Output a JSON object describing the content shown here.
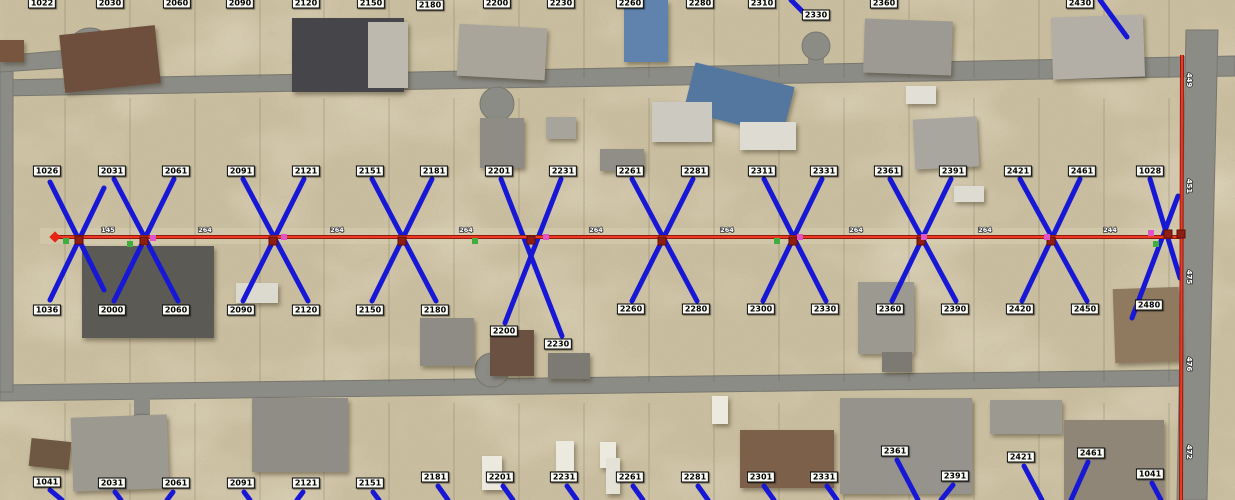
{
  "app": {
    "name": "aerial-utility-service-map"
  },
  "palette": {
    "terrain": "#c9bd9f",
    "terrain_light": "#ddd3b6",
    "scrub_dark": "#6b6350",
    "road": "#8c8c86",
    "road_edge": "#77776f",
    "service_blue": "#1717d6",
    "main_red": "#ee3a22",
    "main_red_dark": "#8f1b10",
    "node_crossing": "#8e1e12",
    "node_green": "#3fae3f",
    "node_magenta": "#e054c8",
    "terminus_red": "#e82416",
    "label_bg": "#fbfbf6",
    "label_border": "#000000"
  },
  "roads": [
    {
      "name": "top-road",
      "points": "0,80 1235,56 1235,76 0,96"
    },
    {
      "name": "bottom-road",
      "points": "0,385 1180,370 1180,386 0,401"
    },
    {
      "name": "right-road",
      "points": "1186,30 1218,30 1207,500 1177,500"
    },
    {
      "name": "left-road",
      "points": "0,58 13,58 13,392 0,392"
    },
    {
      "name": "top-left-spur",
      "points": "0,56 92,48 92,66 0,72"
    }
  ],
  "road_bulbs": [
    {
      "x": 90,
      "y": 50,
      "r": 22
    },
    {
      "x": 142,
      "y": 434,
      "r": 20
    },
    {
      "x": 497,
      "y": 104,
      "r": 17
    },
    {
      "x": 492,
      "y": 370,
      "r": 17
    },
    {
      "x": 816,
      "y": 46,
      "r": 14
    }
  ],
  "road_stubs": [
    {
      "x": 489,
      "y": 86,
      "w": 16,
      "h": 22
    },
    {
      "x": 484,
      "y": 360,
      "w": 16,
      "h": 28
    },
    {
      "x": 134,
      "y": 396,
      "w": 16,
      "h": 40
    },
    {
      "x": 808,
      "y": 42,
      "w": 16,
      "h": 28
    }
  ],
  "parcel_xs": [
    65,
    130,
    195,
    260,
    324,
    389,
    454,
    519,
    584,
    649,
    714,
    779,
    844,
    909,
    974,
    1039,
    1104,
    1169
  ],
  "houses": [
    {
      "x": 0,
      "y": 40,
      "w": 24,
      "h": 22,
      "c": "#77553f",
      "r": 0
    },
    {
      "x": 62,
      "y": 30,
      "w": 96,
      "h": 58,
      "c": "#6e4e3c",
      "r": -6
    },
    {
      "x": 292,
      "y": 18,
      "w": 112,
      "h": 74,
      "c": "#46454a",
      "r": 0
    },
    {
      "x": 368,
      "y": 22,
      "w": 40,
      "h": 66,
      "c": "#bdb9ae",
      "r": 0
    },
    {
      "x": 458,
      "y": 26,
      "w": 88,
      "h": 52,
      "c": "#a9a59b",
      "r": 3
    },
    {
      "x": 624,
      "y": 0,
      "w": 44,
      "h": 62,
      "c": "#5f83ad",
      "r": 0
    },
    {
      "x": 688,
      "y": 74,
      "w": 102,
      "h": 50,
      "c": "#53779f",
      "r": 14
    },
    {
      "x": 864,
      "y": 20,
      "w": 88,
      "h": 54,
      "c": "#9d9a93",
      "r": 2
    },
    {
      "x": 1052,
      "y": 16,
      "w": 92,
      "h": 62,
      "c": "#b3afa6",
      "r": -2
    },
    {
      "x": 906,
      "y": 86,
      "w": 30,
      "h": 18,
      "c": "#e2dfd6",
      "r": 0
    },
    {
      "x": 82,
      "y": 246,
      "w": 132,
      "h": 92,
      "c": "#5b5a55",
      "r": 0
    },
    {
      "x": 236,
      "y": 283,
      "w": 42,
      "h": 20,
      "c": "#dcd9cf",
      "r": 0
    },
    {
      "x": 480,
      "y": 118,
      "w": 44,
      "h": 50,
      "c": "#8f8c85",
      "r": 0
    },
    {
      "x": 546,
      "y": 117,
      "w": 30,
      "h": 22,
      "c": "#a7a49c",
      "r": 0
    },
    {
      "x": 652,
      "y": 102,
      "w": 60,
      "h": 40,
      "c": "#ccc9c0",
      "r": 0
    },
    {
      "x": 740,
      "y": 122,
      "w": 56,
      "h": 28,
      "c": "#dedbd2",
      "r": 0
    },
    {
      "x": 600,
      "y": 149,
      "w": 44,
      "h": 22,
      "c": "#918e87",
      "r": 0
    },
    {
      "x": 914,
      "y": 118,
      "w": 64,
      "h": 50,
      "c": "#a9a6a0",
      "r": -3
    },
    {
      "x": 954,
      "y": 186,
      "w": 30,
      "h": 16,
      "c": "#dedbd2",
      "r": 0
    },
    {
      "x": 420,
      "y": 318,
      "w": 54,
      "h": 48,
      "c": "#8f8c85",
      "r": 0
    },
    {
      "x": 490,
      "y": 330,
      "w": 44,
      "h": 46,
      "c": "#6b5141",
      "r": 0
    },
    {
      "x": 548,
      "y": 353,
      "w": 42,
      "h": 26,
      "c": "#7d7a73",
      "r": 0
    },
    {
      "x": 858,
      "y": 282,
      "w": 56,
      "h": 72,
      "c": "#9c9991",
      "r": 0
    },
    {
      "x": 882,
      "y": 352,
      "w": 30,
      "h": 20,
      "c": "#7d7a73",
      "r": 0
    },
    {
      "x": 1114,
      "y": 288,
      "w": 66,
      "h": 74,
      "c": "#8f7a60",
      "r": -2
    },
    {
      "x": 30,
      "y": 440,
      "w": 40,
      "h": 28,
      "c": "#6e5844",
      "r": 6
    },
    {
      "x": 72,
      "y": 416,
      "w": 96,
      "h": 74,
      "c": "#9c9991",
      "r": -2
    },
    {
      "x": 252,
      "y": 398,
      "w": 96,
      "h": 74,
      "c": "#908d86",
      "r": 0
    },
    {
      "x": 740,
      "y": 430,
      "w": 94,
      "h": 58,
      "c": "#7c604a",
      "r": 0
    },
    {
      "x": 840,
      "y": 398,
      "w": 132,
      "h": 96,
      "c": "#96938c",
      "r": 0
    },
    {
      "x": 990,
      "y": 400,
      "w": 72,
      "h": 34,
      "c": "#9c9991",
      "r": 0
    },
    {
      "x": 1064,
      "y": 420,
      "w": 100,
      "h": 80,
      "c": "#8f8678",
      "r": 0
    },
    {
      "x": 482,
      "y": 456,
      "w": 20,
      "h": 34,
      "c": "#eceadf",
      "r": 0
    },
    {
      "x": 556,
      "y": 441,
      "w": 18,
      "h": 30,
      "c": "#eceadf",
      "r": 0
    },
    {
      "x": 600,
      "y": 442,
      "w": 16,
      "h": 26,
      "c": "#eceadf",
      "r": 0
    },
    {
      "x": 606,
      "y": 458,
      "w": 14,
      "h": 36,
      "c": "#e4e1d6",
      "r": 0
    },
    {
      "x": 712,
      "y": 396,
      "w": 16,
      "h": 28,
      "c": "#eceadf",
      "r": 0
    }
  ],
  "service_lines": [
    [
      50,
      182,
      104,
      290
    ],
    [
      50,
      300,
      104,
      188
    ],
    [
      114,
      179,
      178,
      301
    ],
    [
      174,
      179,
      114,
      301
    ],
    [
      243,
      179,
      308,
      301
    ],
    [
      304,
      179,
      243,
      301
    ],
    [
      372,
      179,
      436,
      301
    ],
    [
      432,
      179,
      372,
      301
    ],
    [
      501,
      179,
      562,
      336
    ],
    [
      561,
      179,
      505,
      323
    ],
    [
      632,
      179,
      697,
      301
    ],
    [
      693,
      179,
      632,
      301
    ],
    [
      764,
      179,
      826,
      301
    ],
    [
      822,
      179,
      763,
      301
    ],
    [
      890,
      179,
      956,
      301
    ],
    [
      951,
      179,
      892,
      301
    ],
    [
      1020,
      179,
      1087,
      301
    ],
    [
      1080,
      179,
      1022,
      301
    ],
    [
      1150,
      179,
      1180,
      278
    ],
    [
      1178,
      196,
      1132,
      318
    ],
    [
      791,
      0,
      805,
      14
    ],
    [
      1100,
      0,
      1127,
      37
    ],
    [
      50,
      490,
      62,
      500
    ],
    [
      115,
      492,
      121,
      500
    ],
    [
      173,
      492,
      167,
      500
    ],
    [
      244,
      492,
      250,
      500
    ],
    [
      303,
      492,
      297,
      500
    ],
    [
      373,
      492,
      379,
      500
    ],
    [
      438,
      486,
      448,
      500
    ],
    [
      503,
      486,
      513,
      500
    ],
    [
      567,
      486,
      577,
      500
    ],
    [
      633,
      486,
      643,
      500
    ],
    [
      698,
      486,
      708,
      500
    ],
    [
      764,
      486,
      774,
      500
    ],
    [
      827,
      486,
      837,
      500
    ],
    [
      897,
      460,
      918,
      500
    ],
    [
      953,
      485,
      941,
      500
    ],
    [
      1024,
      466,
      1042,
      500
    ],
    [
      1088,
      462,
      1071,
      500
    ],
    [
      1152,
      483,
      1161,
      500
    ]
  ],
  "main_lines": {
    "red_main": {
      "x1": 55,
      "y1": 237,
      "x2": 1182,
      "y2": 237
    },
    "red_vertical": {
      "x1": 1182,
      "y1": 55,
      "x2": 1181,
      "y2": 500
    }
  },
  "nodes": {
    "terminus": {
      "x": 55,
      "y": 237
    },
    "crossings": [
      [
        79,
        240
      ],
      [
        144,
        241
      ],
      [
        273,
        241
      ],
      [
        402,
        241
      ],
      [
        531,
        240
      ],
      [
        662,
        241
      ],
      [
        793,
        241
      ],
      [
        921,
        241
      ],
      [
        1051,
        241
      ],
      [
        1168,
        234
      ],
      [
        1181,
        234
      ]
    ],
    "green": [
      [
        66,
        241
      ],
      [
        130,
        244
      ],
      [
        475,
        241
      ],
      [
        777,
        241
      ],
      [
        1156,
        244
      ]
    ],
    "magenta": [
      [
        153,
        238
      ],
      [
        284,
        237
      ],
      [
        546,
        237
      ],
      [
        800,
        237
      ],
      [
        924,
        237
      ],
      [
        1047,
        237
      ],
      [
        1151,
        233
      ]
    ]
  },
  "distance_labels": [
    {
      "t": "145",
      "x": 108,
      "y": 232
    },
    {
      "t": "264",
      "x": 205,
      "y": 232
    },
    {
      "t": "264",
      "x": 337,
      "y": 232
    },
    {
      "t": "264",
      "x": 466,
      "y": 232
    },
    {
      "t": "264",
      "x": 596,
      "y": 232
    },
    {
      "t": "264",
      "x": 727,
      "y": 232
    },
    {
      "t": "264",
      "x": 856,
      "y": 232
    },
    {
      "t": "264",
      "x": 985,
      "y": 232
    },
    {
      "t": "244",
      "x": 1110,
      "y": 232
    }
  ],
  "vertical_labels": [
    {
      "t": "449",
      "y": 80
    },
    {
      "t": "451",
      "y": 186
    },
    {
      "t": "475",
      "y": 277
    },
    {
      "t": "476",
      "y": 364
    },
    {
      "t": "472",
      "y": 452
    }
  ],
  "address_labels": {
    "top_edge": [
      {
        "t": "1022",
        "x": 42,
        "y": 3
      },
      {
        "t": "2030",
        "x": 110,
        "y": 3
      },
      {
        "t": "2060",
        "x": 177,
        "y": 3
      },
      {
        "t": "2090",
        "x": 240,
        "y": 3
      },
      {
        "t": "2120",
        "x": 306,
        "y": 3
      },
      {
        "t": "2150",
        "x": 371,
        "y": 3
      },
      {
        "t": "2180",
        "x": 430,
        "y": 5
      },
      {
        "t": "2200",
        "x": 497,
        "y": 3
      },
      {
        "t": "2230",
        "x": 561,
        "y": 3
      },
      {
        "t": "2260",
        "x": 630,
        "y": 3
      },
      {
        "t": "2280",
        "x": 700,
        "y": 3
      },
      {
        "t": "2310",
        "x": 762,
        "y": 3
      },
      {
        "t": "2330",
        "x": 816,
        "y": 15
      },
      {
        "t": "2360",
        "x": 884,
        "y": 3
      },
      {
        "t": "2430",
        "x": 1080,
        "y": 3
      }
    ],
    "upper_row": [
      {
        "t": "1026",
        "x": 47,
        "y": 171
      },
      {
        "t": "2031",
        "x": 112,
        "y": 171
      },
      {
        "t": "2061",
        "x": 176,
        "y": 171
      },
      {
        "t": "2091",
        "x": 241,
        "y": 171
      },
      {
        "t": "2121",
        "x": 306,
        "y": 171
      },
      {
        "t": "2151",
        "x": 370,
        "y": 171
      },
      {
        "t": "2181",
        "x": 434,
        "y": 171
      },
      {
        "t": "2201",
        "x": 499,
        "y": 171
      },
      {
        "t": "2231",
        "x": 563,
        "y": 171
      },
      {
        "t": "2261",
        "x": 630,
        "y": 171
      },
      {
        "t": "2281",
        "x": 695,
        "y": 171
      },
      {
        "t": "2311",
        "x": 762,
        "y": 171
      },
      {
        "t": "2331",
        "x": 824,
        "y": 171
      },
      {
        "t": "2361",
        "x": 888,
        "y": 171
      },
      {
        "t": "2391",
        "x": 953,
        "y": 171
      },
      {
        "t": "2421",
        "x": 1018,
        "y": 171
      },
      {
        "t": "2461",
        "x": 1082,
        "y": 171
      },
      {
        "t": "1028",
        "x": 1150,
        "y": 171
      }
    ],
    "lower_row": [
      {
        "t": "1036",
        "x": 47,
        "y": 310
      },
      {
        "t": "2000",
        "x": 112,
        "y": 310
      },
      {
        "t": "2060",
        "x": 176,
        "y": 310
      },
      {
        "t": "2090",
        "x": 241,
        "y": 310
      },
      {
        "t": "2120",
        "x": 306,
        "y": 310
      },
      {
        "t": "2150",
        "x": 370,
        "y": 310
      },
      {
        "t": "2180",
        "x": 435,
        "y": 310
      },
      {
        "t": "2200",
        "x": 504,
        "y": 331
      },
      {
        "t": "2230",
        "x": 558,
        "y": 344
      },
      {
        "t": "2260",
        "x": 631,
        "y": 309
      },
      {
        "t": "2280",
        "x": 696,
        "y": 309
      },
      {
        "t": "2300",
        "x": 761,
        "y": 309
      },
      {
        "t": "2330",
        "x": 825,
        "y": 309
      },
      {
        "t": "2360",
        "x": 890,
        "y": 309
      },
      {
        "t": "2390",
        "x": 955,
        "y": 309
      },
      {
        "t": "2420",
        "x": 1020,
        "y": 309
      },
      {
        "t": "2450",
        "x": 1085,
        "y": 309
      },
      {
        "t": "2480",
        "x": 1149,
        "y": 305
      }
    ],
    "bottom_row": [
      {
        "t": "1041",
        "x": 47,
        "y": 482
      },
      {
        "t": "2031",
        "x": 112,
        "y": 483
      },
      {
        "t": "2061",
        "x": 176,
        "y": 483
      },
      {
        "t": "2091",
        "x": 241,
        "y": 483
      },
      {
        "t": "2121",
        "x": 306,
        "y": 483
      },
      {
        "t": "2151",
        "x": 370,
        "y": 483
      },
      {
        "t": "2181",
        "x": 435,
        "y": 477
      },
      {
        "t": "2201",
        "x": 500,
        "y": 477
      },
      {
        "t": "2231",
        "x": 564,
        "y": 477
      },
      {
        "t": "2261",
        "x": 630,
        "y": 477
      },
      {
        "t": "2281",
        "x": 695,
        "y": 477
      },
      {
        "t": "2301",
        "x": 761,
        "y": 477
      },
      {
        "t": "2331",
        "x": 824,
        "y": 477
      },
      {
        "t": "2361",
        "x": 895,
        "y": 451
      },
      {
        "t": "2391",
        "x": 955,
        "y": 476
      },
      {
        "t": "2421",
        "x": 1021,
        "y": 457
      },
      {
        "t": "2461",
        "x": 1091,
        "y": 453
      },
      {
        "t": "1041",
        "x": 1150,
        "y": 474
      }
    ]
  }
}
